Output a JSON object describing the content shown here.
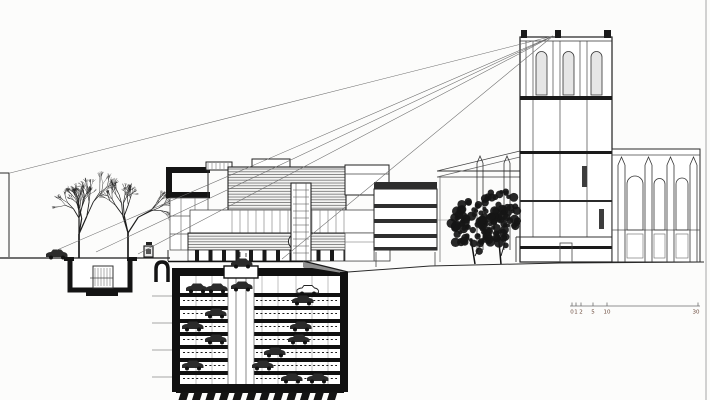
{
  "meta": {
    "description": "Architectural section-elevation drawing: modern building with deep underground mechanical parking garage, bare trees at left, sight lines fanning to a church tower at right",
    "background": "#fcfcfb",
    "ink": "#1b1b1b",
    "scale_text_color": "#6b4a3c"
  },
  "scale_bar": {
    "labels": [
      "0",
      "1",
      "2",
      "5",
      "10",
      "30"
    ],
    "label_x": [
      572,
      576,
      581,
      593,
      607,
      696
    ],
    "tick_x": [
      572,
      576,
      581,
      593,
      607,
      698
    ],
    "baseline": [
      570,
      306,
      700,
      306
    ]
  },
  "drawing": {
    "sight_lines": [
      [
        10,
        173,
        553,
        36
      ],
      [
        57,
        250,
        553,
        36
      ],
      [
        96,
        252,
        553,
        36
      ],
      [
        138,
        254,
        553,
        36
      ],
      [
        282,
        259,
        553,
        36
      ]
    ],
    "bare_trees": [
      {
        "x": 79,
        "g": 258,
        "len": 24,
        "depth": 6,
        "seed": 21,
        "lean": 0.06
      },
      {
        "x": 128,
        "g": 258,
        "len": 25,
        "depth": 6,
        "seed": 77,
        "lean": -0.05
      }
    ],
    "leafy_trees": [
      {
        "cx": 473,
        "cy": 227,
        "rx": 22,
        "ry": 27,
        "tx": 475,
        "g": 264,
        "seed": 5,
        "n": 85
      },
      {
        "cx": 500,
        "cy": 218,
        "rx": 20,
        "ry": 29,
        "tx": 501,
        "g": 264,
        "seed": 11,
        "n": 95
      }
    ],
    "garage": {
      "x1": 172,
      "x2": 348,
      "top": 268,
      "wall": 8,
      "floors": [
        293,
        306,
        319,
        332,
        345,
        358,
        371
      ],
      "slabH": 4,
      "dash": [
        300.5,
        313.5,
        326.5,
        339.5,
        352.5,
        365.5,
        378.5
      ],
      "cols": [
        196,
        212,
        262,
        278,
        296,
        312,
        328
      ],
      "shaft": {
        "x": 228,
        "w": 26,
        "lines": [
          228,
          236,
          246,
          254
        ]
      },
      "entrance": {
        "x": 224,
        "y": 266,
        "w": 34,
        "h": 12
      },
      "cars": [
        [
          186,
          283
        ],
        [
          206,
          283
        ],
        [
          231,
          281
        ],
        [
          297,
          285,
          1
        ],
        [
          292,
          295
        ],
        [
          205,
          308
        ],
        [
          182,
          321
        ],
        [
          290,
          321
        ],
        [
          205,
          334
        ],
        [
          288,
          334
        ],
        [
          264,
          347
        ],
        [
          182,
          360
        ],
        [
          252,
          360
        ],
        [
          281,
          373
        ],
        [
          307,
          373
        ]
      ],
      "tiebacks": [
        296,
        323,
        350,
        377
      ],
      "piles": {
        "x0": 181,
        "x1": 341,
        "step": 13.5,
        "w": 8,
        "y": 392
      }
    },
    "layers": {
      "ground": [
        [
          "l",
          0,
          258,
          170,
          258,
          1.3,
          "#1c1c1c"
        ],
        [
          "pg",
          [
            [
              303,
              261
            ],
            [
              348,
              272
            ],
            [
              348,
              281
            ],
            [
              312,
              276
            ],
            [
              303,
              267
            ]
          ],
          "#8f8f8f"
        ],
        [
          "l",
          303,
          261,
          348,
          272,
          1.4,
          "#1c1c1c"
        ],
        [
          "l",
          348,
          272,
          430,
          266,
          1,
          "#2a2a2a"
        ],
        [
          "l",
          430,
          266,
          560,
          263,
          1,
          "#2a2a2a"
        ],
        [
          "l",
          560,
          263,
          704,
          262,
          1,
          "#2a2a2a"
        ],
        [
          "pl",
          [
            [
              0,
              173
            ],
            [
              9,
              173
            ],
            [
              9,
              257
            ]
          ],
          1,
          "#2a2a2a"
        ]
      ],
      "underpass": [
        [
          "p",
          "M70,259 V290 H130 V259",
          5,
          "#141414",
          "#ffffff"
        ],
        [
          "fr",
          86,
          290,
          32,
          6,
          "#141414"
        ],
        [
          "fr",
          64,
          257,
          10,
          4,
          "#141414"
        ],
        [
          "fr",
          127,
          257,
          10,
          4,
          "#141414"
        ],
        [
          "r",
          93,
          266,
          20,
          22,
          1,
          "#333333",
          "#ffffff"
        ],
        [
          "vh",
          95,
          268,
          16,
          18,
          3
        ],
        [
          "l",
          90,
          278,
          113,
          278,
          0.8,
          "#444444"
        ]
      ],
      "tunnel": [
        [
          "p",
          "M156,282 V269 Q156,262 162,262 Q168,262 168,269 V282",
          3.5,
          "#141414",
          "#ffffff"
        ]
      ],
      "street": [
        [
          "fr",
          146,
          242,
          6,
          3,
          "#222222"
        ],
        [
          "r",
          144,
          246,
          9,
          11,
          1.2,
          "#222222",
          "#e8e8e8"
        ],
        [
          "fr",
          146,
          249,
          5,
          5,
          "#555555"
        ]
      ],
      "building": [
        [
          "fr",
          166,
          167,
          44,
          6,
          "#141414"
        ],
        [
          "fr",
          166,
          167,
          6,
          31,
          "#141414"
        ],
        [
          "fr",
          166,
          192,
          44,
          6,
          "#141414"
        ],
        [
          "l",
          208,
          167,
          208,
          198,
          1,
          "#2a2a2a"
        ],
        [
          "r",
          170,
          198,
          38,
          52,
          0.8,
          "#555555",
          "#ffffff"
        ],
        [
          "l",
          170,
          216,
          208,
          216,
          0.7,
          "#555555"
        ],
        [
          "l",
          170,
          234,
          208,
          234,
          0.7,
          "#555555"
        ],
        [
          "l",
          181,
          198,
          181,
          250,
          0.7,
          "#777777"
        ],
        [
          "l",
          195,
          198,
          195,
          250,
          0.7,
          "#777777"
        ],
        [
          "r",
          206,
          162,
          26,
          8,
          1,
          "#222222",
          "#ffffff"
        ],
        [
          "vh",
          208,
          163,
          22,
          6,
          4
        ],
        [
          "r",
          252,
          159,
          38,
          9,
          1,
          "#222222",
          "#ffffff"
        ],
        [
          "hr",
          228,
          167,
          118,
          43
        ],
        [
          "r",
          228,
          167,
          118,
          43,
          1.1,
          "#222222"
        ],
        [
          "r",
          345,
          165,
          44,
          30,
          1,
          "#222222",
          "#ffffff"
        ],
        [
          "l",
          345,
          174,
          389,
          174,
          0.7,
          "#444444"
        ],
        [
          "r",
          190,
          210,
          198,
          23,
          0.8,
          "#444444",
          "#ffffff"
        ],
        [
          "vh",
          232,
          210,
          112,
          23,
          8
        ],
        [
          "hr",
          188,
          233,
          202,
          17
        ],
        [
          "r",
          188,
          233,
          202,
          17,
          1,
          "#222222"
        ],
        [
          "c",
          296,
          241.5,
          7.5,
          1,
          "#222222",
          "#ffffff"
        ],
        [
          "r",
          188,
          250,
          202,
          11,
          0.8,
          "#333333",
          "#ffffff"
        ],
        [
          "cb",
          195,
          383,
          13.5,
          250,
          4,
          11
        ],
        [
          "r",
          291,
          183,
          20,
          78,
          1.1,
          "#222222",
          "#ffffff"
        ],
        [
          "hh",
          293,
          190,
          16,
          66,
          7
        ],
        [
          "l",
          296,
          183,
          296,
          261,
          0.6,
          "#555555"
        ],
        [
          "l",
          306,
          183,
          306,
          261,
          0.6,
          "#555555"
        ],
        [
          "r",
          345,
          233,
          29,
          28,
          0.8,
          "#555555",
          "#ffffff"
        ],
        [
          "l",
          345,
          242,
          374,
          242,
          0.6,
          "#666666"
        ],
        [
          "l",
          168,
          261.5,
          303,
          261.5,
          1.6,
          "#141414"
        ],
        [
          "l",
          168,
          250,
          168,
          261,
          1,
          "#2a2a2a"
        ]
      ],
      "banded": [
        [
          "r",
          374,
          189,
          63,
          61,
          1,
          "#222222",
          "#ffffff"
        ],
        [
          "fr",
          374,
          182,
          63,
          7,
          "#2e2e2e"
        ],
        [
          "fr",
          374,
          204,
          63,
          4,
          "#2e2e2e"
        ],
        [
          "fr",
          374,
          219,
          63,
          4,
          "#2e2e2e"
        ],
        [
          "fr",
          374,
          234,
          63,
          4,
          "#2e2e2e"
        ],
        [
          "fr",
          374,
          247,
          63,
          3,
          "#2e2e2e"
        ],
        [
          "l",
          376,
          252,
          376,
          267,
          0.8,
          "#444444"
        ],
        [
          "l",
          435,
          252,
          435,
          266,
          0.8,
          "#444444"
        ]
      ],
      "aisle": [
        [
          "l",
          437,
          171,
          520,
          171,
          0.9,
          "#333333"
        ],
        [
          "l",
          437,
          177,
          520,
          177,
          0.8,
          "#333333"
        ],
        [
          "l",
          437,
          171,
          520,
          151,
          0.8,
          "#444444"
        ],
        [
          "l",
          437,
          177,
          520,
          157,
          0.7,
          "#666666"
        ],
        [
          "pn",
          477,
          6,
          156,
          163,
          250
        ],
        [
          "pn",
          504,
          6,
          156,
          163,
          250
        ],
        [
          "l",
          440,
          177,
          440,
          262,
          0.7,
          "#666666"
        ],
        [
          "l",
          437,
          220,
          470,
          220,
          0.6,
          "#888888"
        ]
      ],
      "tower": [
        [
          "r",
          520,
          37,
          92,
          225,
          1.2,
          "#1f1f1f",
          "#ffffff"
        ],
        [
          "l",
          520,
          41,
          612,
          41,
          0.8,
          "#333333"
        ],
        [
          "fr",
          521,
          30,
          6,
          8,
          "#1a1a1a"
        ],
        [
          "fr",
          555,
          30,
          6,
          8,
          "#1a1a1a"
        ],
        [
          "fr",
          604,
          30,
          7,
          8,
          "#1a1a1a"
        ],
        [
          "l",
          526,
          41,
          526,
          96,
          0.7,
          "#444444"
        ],
        [
          "l",
          533,
          41,
          533,
          237,
          0.7,
          "#444444"
        ],
        [
          "l",
          553,
          41,
          553,
          96,
          0.7,
          "#444444"
        ],
        [
          "l",
          560,
          41,
          560,
          237,
          0.7,
          "#444444"
        ],
        [
          "l",
          580,
          41,
          580,
          96,
          0.7,
          "#444444"
        ],
        [
          "l",
          587,
          41,
          587,
          237,
          0.7,
          "#444444"
        ],
        [
          "lan",
          536,
          57,
          11,
          38
        ],
        [
          "lan",
          563,
          57,
          11,
          38
        ],
        [
          "lan",
          591,
          57,
          11,
          38
        ],
        [
          "fr",
          520,
          96,
          92,
          4,
          "#1a1a1a"
        ],
        [
          "fr",
          520,
          151,
          92,
          3,
          "#1a1a1a"
        ],
        [
          "fr",
          520,
          200,
          92,
          2,
          "#2a2a2a"
        ],
        [
          "fr",
          520,
          246,
          92,
          3,
          "#1a1a1a"
        ],
        [
          "fr",
          582,
          166,
          5,
          21,
          "#3d3d3d"
        ],
        [
          "fr",
          599,
          209,
          5,
          20,
          "#3d3d3d"
        ],
        [
          "l",
          516,
          237,
          616,
          237,
          0.9,
          "#333333"
        ],
        [
          "l",
          516,
          237,
          516,
          262,
          0.9,
          "#333333"
        ],
        [
          "l",
          616,
          237,
          616,
          262,
          0.9,
          "#333333"
        ],
        [
          "r",
          560,
          243,
          12,
          19,
          0.8,
          "#444444"
        ]
      ],
      "nave": [
        [
          "r",
          612,
          149,
          88,
          113,
          1,
          "#2a2a2a",
          "#ffffff"
        ],
        [
          "l",
          612,
          155,
          700,
          155,
          0.7,
          "#444444"
        ],
        [
          "l",
          612,
          230,
          700,
          230,
          0.7,
          "#555555"
        ],
        [
          "pn",
          618,
          7,
          157,
          165,
          262
        ],
        [
          "pn",
          645,
          7,
          157,
          165,
          262
        ],
        [
          "pn",
          667,
          7,
          157,
          165,
          262
        ],
        [
          "pn",
          690,
          7,
          157,
          165,
          262
        ],
        [
          "lan",
          627,
          184,
          16,
          46,
          "none"
        ],
        [
          "lan",
          654,
          184,
          11,
          46,
          "none"
        ],
        [
          "lan",
          676,
          184,
          12,
          46,
          "none"
        ],
        [
          "r",
          627,
          234,
          16,
          24,
          0.6,
          "#666666"
        ],
        [
          "r",
          654,
          234,
          11,
          24,
          0.6,
          "#666666"
        ],
        [
          "r",
          676,
          234,
          12,
          24,
          0.6,
          "#666666"
        ]
      ],
      "scale": [
        [
          "l",
          570,
          306,
          700,
          306,
          0.8,
          "#6d6d6d"
        ],
        [
          "l",
          572,
          302.5,
          572,
          306,
          0.8,
          "#6d6d6d"
        ],
        [
          "l",
          576,
          302.5,
          576,
          306,
          0.8,
          "#6d6d6d"
        ],
        [
          "l",
          581,
          302.5,
          581,
          306,
          0.8,
          "#6d6d6d"
        ],
        [
          "l",
          593,
          302.5,
          593,
          306,
          0.8,
          "#6d6d6d"
        ],
        [
          "l",
          607,
          302.5,
          607,
          306,
          0.8,
          "#6d6d6d"
        ],
        [
          "l",
          698,
          302.5,
          698,
          306,
          0.8,
          "#6d6d6d"
        ]
      ],
      "frame": [
        [
          "l",
          706,
          0,
          706,
          400,
          1.2,
          "#b5b5b5"
        ]
      ]
    }
  }
}
